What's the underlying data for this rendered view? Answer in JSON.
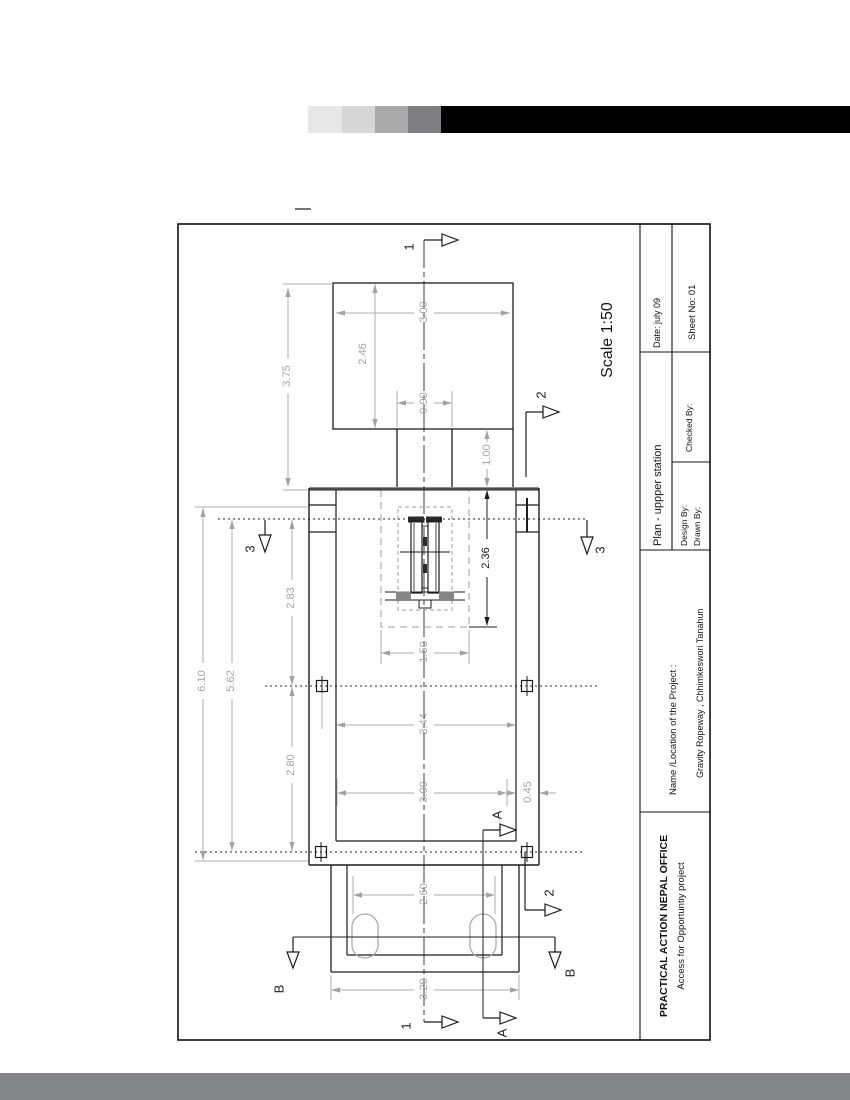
{
  "page": {
    "gradient_swatches": [
      "#e7e7e9",
      "#d6d6d8",
      "#a9a9ab",
      "#7f7f83"
    ],
    "header_bar_color": "#000000",
    "footer_bar_color": "#838689"
  },
  "title_block": {
    "org_name": "PRACTICAL ACTION NEPAL OFFICE",
    "org_tagline": "Access for Opportuntiy project",
    "project_label": "Name /Location of the Project :",
    "project_name": "Gravity Ropeway ,  Chhimkeswori Tanahun",
    "drawing_title": "Plan - uppper station",
    "design_by_label": "Design By:",
    "drawn_by_label": "Drawn By:",
    "checked_by_label": "Checked  By:",
    "date_label": "Date: july 09",
    "sheet_label": "Sheet No: 01"
  },
  "drawing": {
    "scale_label": "Scale 1:50",
    "dimensions": {
      "overall_length": "6.10",
      "inner_length": "5.62",
      "upper_bay": "2.83",
      "lower_bay": "2.80",
      "approach_length": "3.75",
      "top_block_width": "3.00",
      "top_block_depth": "2.46",
      "corridor_width": "0.90",
      "corridor_length": "1.00",
      "clearance_length": "2.36",
      "clearance_width": "1.50",
      "inner_width": "3.44",
      "opening_width": "3.00",
      "wall_offset": "0.45",
      "column_spacing": "2.60",
      "platform_width": "3.20"
    },
    "sections": {
      "s1": "1",
      "s2": "2",
      "s3": "3",
      "sA": "A",
      "sB": "B"
    }
  }
}
